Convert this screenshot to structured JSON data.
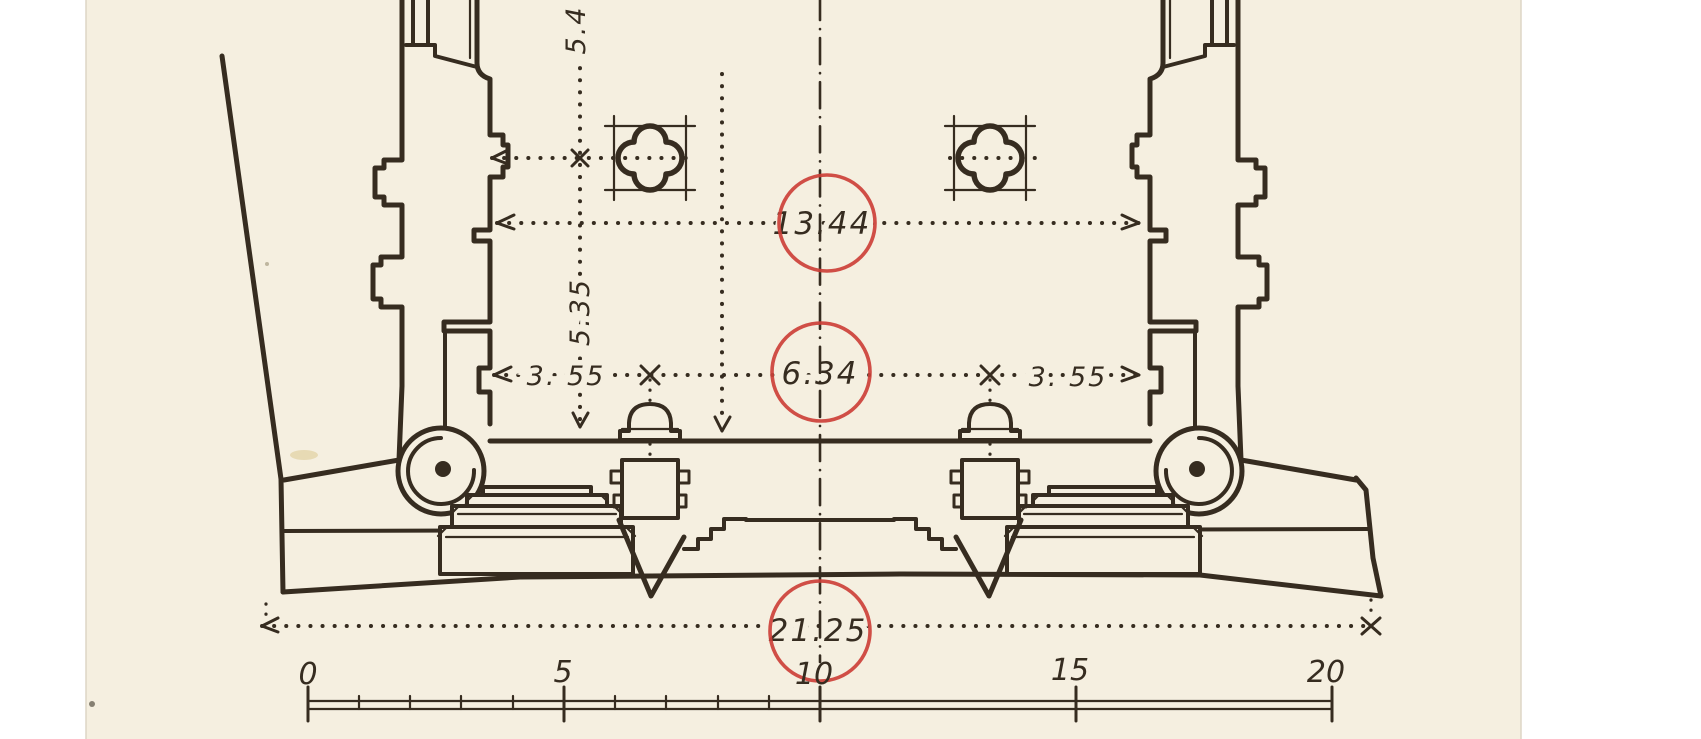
{
  "palette": {
    "paper": "#f5efe0",
    "ink": "#362c20",
    "highlight_red": "#cc4038",
    "margin": "#ffffff"
  },
  "drawing": {
    "dimensions": {
      "vertical_top_partial": "5.4",
      "vertical_side": "5.35",
      "upper_width": "13.44",
      "left_bay": "3. 55",
      "center_bay": "6.34",
      "right_bay": "3. 55",
      "total_width": "21.25"
    },
    "scale_bar": {
      "labels": [
        "0",
        "5",
        "10",
        "15",
        "20"
      ]
    }
  }
}
